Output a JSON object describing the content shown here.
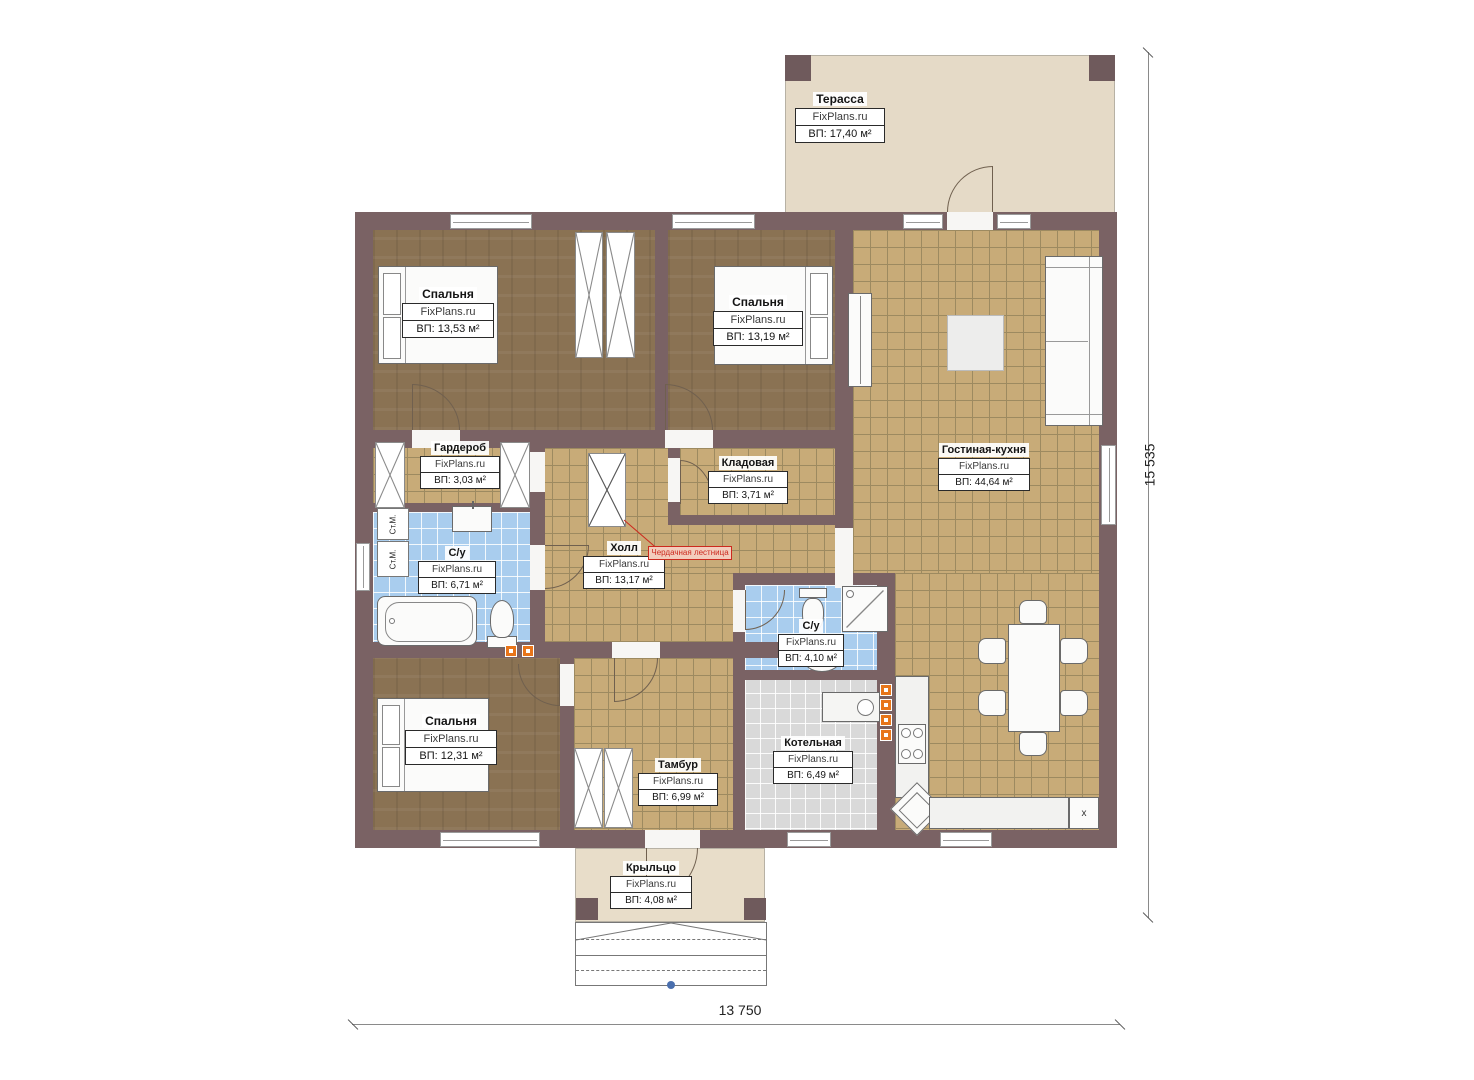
{
  "watermark": "FixPlans.ru",
  "rooms": {
    "terrace": {
      "name": "Терасса",
      "area": "ВП: 17,40 м²"
    },
    "bedroom1": {
      "name": "Спальня",
      "area": "ВП: 13,53 м²"
    },
    "bedroom2": {
      "name": "Спальня",
      "area": "ВП: 13,19 м²"
    },
    "wardrobe": {
      "name": "Гардероб",
      "area": "ВП: 3,03 м²"
    },
    "pantry": {
      "name": "Кладовая",
      "area": "ВП: 3,71 м²"
    },
    "living": {
      "name": "Гостиная-кухня",
      "area": "ВП: 44,64 м²"
    },
    "bath1": {
      "name": "С/у",
      "area": "ВП: 6,71 м²"
    },
    "hall": {
      "name": "Холл",
      "area": "ВП: 13,17 м²"
    },
    "bath2": {
      "name": "С/у",
      "area": "ВП: 4,10 м²"
    },
    "bedroom3": {
      "name": "Спальня",
      "area": "ВП: 12,31 м²"
    },
    "tambour": {
      "name": "Тамбур",
      "area": "ВП: 6,99 м²"
    },
    "boiler": {
      "name": "Котельная",
      "area": "ВП: 6,49 м²"
    },
    "porch": {
      "name": "Крыльцо",
      "area": "ВП: 4,08 м²"
    }
  },
  "annotations": {
    "attic_ladder": "Чердачная лестница",
    "washer1": "Ст.М.",
    "washer2": "Ст.М.",
    "fridge": "x"
  },
  "dimensions": {
    "bottom": "13 750",
    "right": "15 535"
  }
}
